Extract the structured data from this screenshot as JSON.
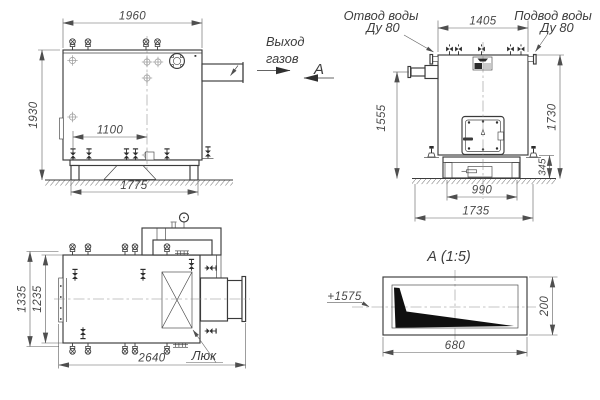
{
  "labels": {
    "gas_outlet_line1": "Выход",
    "gas_outlet_line2": "газов",
    "section_letter": "А",
    "water_outlet_line1": "Отвод воды",
    "water_outlet_line2": "Ду 80",
    "water_inlet_line1": "Подвод воды",
    "water_inlet_line2": "Ду 80",
    "hatch": "Люк",
    "detail_title": "А  (1:5)",
    "elevation": "+1575"
  },
  "dimensions": {
    "front": {
      "width_top": "1960",
      "height_left": "1930",
      "inner_span": "1100",
      "base_span": "1775"
    },
    "side": {
      "width_top": "1405",
      "pipe_height": "1555",
      "height_right": "1730",
      "base_inner": "990",
      "base_outer": "1735",
      "base_height": "345"
    },
    "plan": {
      "width_outer": "1335",
      "width_inner": "1235",
      "length": "2640"
    },
    "detail": {
      "width": "680",
      "height": "200"
    }
  }
}
